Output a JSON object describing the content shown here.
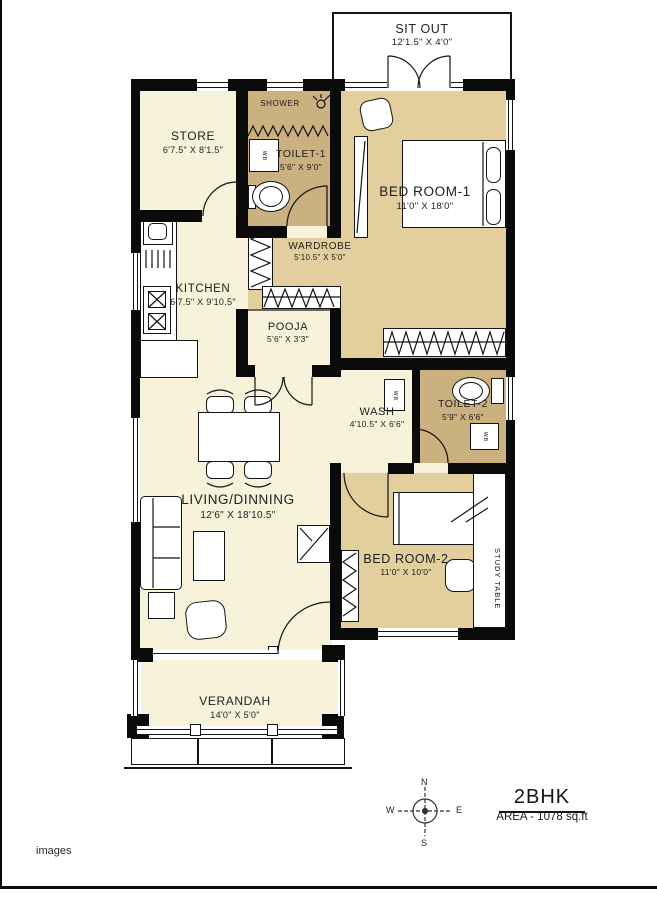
{
  "page": {
    "watermark": "images"
  },
  "title_block": {
    "title": "2BHK",
    "area": "AREA - 1078 sq.ft"
  },
  "compass": {
    "north": "N",
    "south": "S",
    "east": "E",
    "west": "W"
  },
  "rooms": {
    "sitout": {
      "name": "SIT OUT",
      "dims": "12'1.5\" X 4'0\""
    },
    "store": {
      "name": "STORE",
      "dims": "6'7.5\" X 8'1.5\""
    },
    "toilet1": {
      "name": "TOILET-1",
      "dims": "5'6\" X 9'0\""
    },
    "bedroom1": {
      "name": "BED ROOM-1",
      "dims": "11'0\" X 18'0\""
    },
    "wardrobe": {
      "name": "WARDROBE",
      "dims": "5'10.5\" X 5'0\""
    },
    "kitchen": {
      "name": "KITCHEN",
      "dims": "6'7.5\" X 9'10.5\""
    },
    "pooja": {
      "name": "POOJA",
      "dims": "5'6\" X 3'3\""
    },
    "wash": {
      "name": "WASH",
      "dims": "4'10.5\" X 6'6\""
    },
    "toilet2": {
      "name": "TOILET-2",
      "dims": "5'9\" X 6'6\""
    },
    "living": {
      "name": "LIVING/DINNING",
      "dims": "12'6\" X 18'10.5\""
    },
    "bedroom2": {
      "name": "BED ROOM-2",
      "dims": "11'0\" X 10'0\""
    },
    "verandah": {
      "name": "VERANDAH",
      "dims": "14'0\" X 5'0\""
    }
  },
  "fixtures": {
    "shower": "SHOWER",
    "study_table": "STUDY TABLE",
    "washbasin": "W.B"
  },
  "colors": {
    "floor_cream": "#f7f2da",
    "floor_tan": "#e2cf9d",
    "floor_tan_dark": "#cbb080",
    "wall": "#0a0a0a"
  }
}
